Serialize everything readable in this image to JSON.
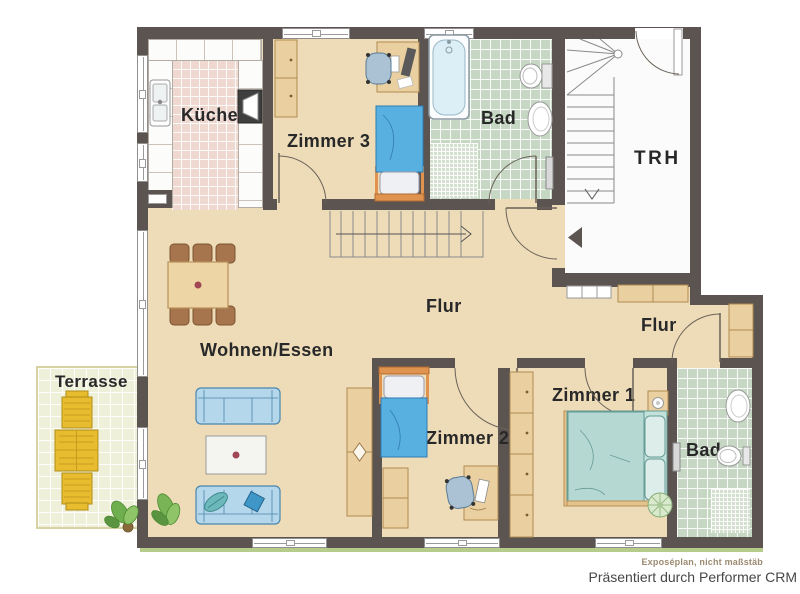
{
  "plan": {
    "rooms": {
      "kueche": "Küche",
      "zimmer3": "Zimmer 3",
      "bad_top": "Bad",
      "trh": "TRH",
      "flur_center": "Flur",
      "wohnen_essen": "Wohnen/Essen",
      "terrasse": "Terrasse",
      "zimmer2": "Zimmer 2",
      "zimmer1": "Zimmer 1",
      "flur_right": "Flur",
      "bad_bottom": "Bad"
    },
    "colors": {
      "wall": "#5b5450",
      "floor_living": "#eedcb9",
      "floor_kitchen_tiles": "#eed8cf",
      "floor_bath_tiles": "#c6d8c4",
      "floor_stairwell": "#fbfbfb",
      "floor_terrace": "#eff0da",
      "furniture_wood": "#ead0a0",
      "sofa_blue": "#b5d7ec",
      "bed_blue": "#58b0e0",
      "bed_teal": "#c3e1db",
      "terrace_furniture_yellow": "#e8bc2f",
      "grass": "#b5cc8a"
    }
  },
  "footer": {
    "disclaimer": "Exposéplan, nicht maßstäb",
    "credit": "Präsentiert durch Performer CRM"
  }
}
